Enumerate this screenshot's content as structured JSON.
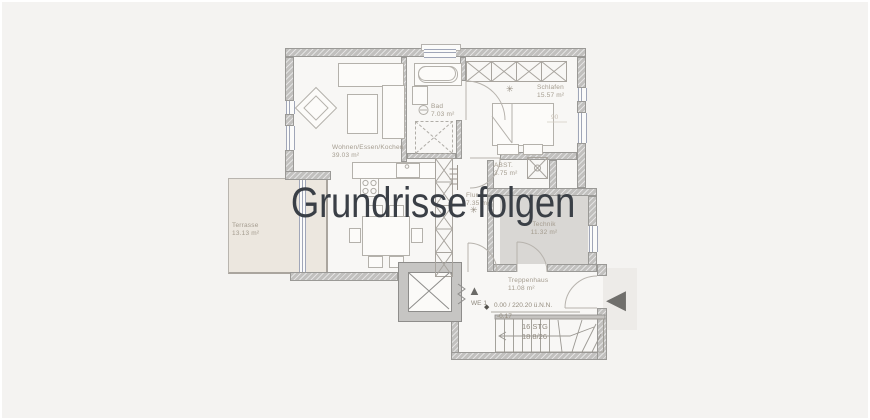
{
  "overlay": {
    "message": "Grundrisse folgen"
  },
  "rooms": {
    "wohnen": {
      "name": "Wohnen/Essen/Kochen",
      "area": "39.03 m²"
    },
    "bad": {
      "name": "Bad",
      "area": "7.03 m²"
    },
    "schlafen": {
      "name": "Schlafen",
      "area": "15.57 m²"
    },
    "flur": {
      "name": "Flur",
      "area": "7.35 m²"
    },
    "abst": {
      "name": "ABST.",
      "area": "3.75 m²"
    },
    "technik": {
      "name": "Technik",
      "area": "11.32 m²"
    },
    "treppenhaus": {
      "name": "Treppenhaus",
      "area": "11.08 m²"
    },
    "terrasse": {
      "name": "Terrasse",
      "area": "13.13 m²"
    }
  },
  "annotations": {
    "unit": "WE 1",
    "elevation": "0.00 / 220.20 ü.N.N.",
    "elevation_offset": "-0.17",
    "stairs_count": "16 STG",
    "stairs_ratio": "18.8/26",
    "bed_width": "90"
  },
  "icons": {
    "unit_arrow": "▲",
    "entry_arrow": "◀",
    "level_marker": "◆",
    "light_symbol": "✳"
  },
  "colors": {
    "background": "#f4f3f1",
    "floor": "#f8f7f5",
    "wall": "#c1c0be",
    "terrace": "#ece7df",
    "technik_floor": "#d9d7d4",
    "overlay_text": "#3a3f46",
    "label_text": "#a49c8f"
  }
}
